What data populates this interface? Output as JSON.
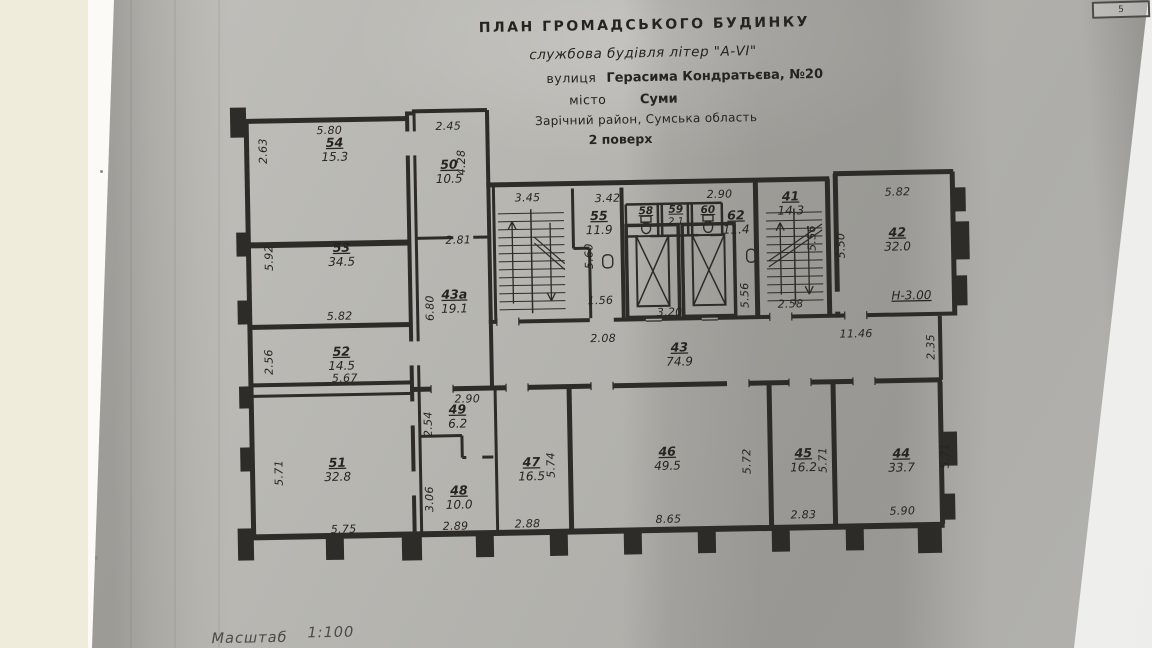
{
  "page": {
    "number": "5"
  },
  "title_block": {
    "line1": "ПЛАН  ГРОМАДСЬКОГО  БУДИНКУ",
    "line2": "службова будівля літер \"А-VI\"",
    "line3_label": "вулиця",
    "line3_value": "Герасима Кондратьєва, №20",
    "line4_label": "місто",
    "line4_value": "Суми",
    "line5": "Зарічний район, Сумська область",
    "line6": "2 поверх"
  },
  "scale": {
    "label": "Масштаб",
    "value": "1:100"
  },
  "height_mark": "Н-3.00",
  "rooms": {
    "r54": {
      "number": "54",
      "area": "15.3"
    },
    "r50": {
      "number": "50",
      "area": "10.5"
    },
    "r53": {
      "number": "53",
      "area": "34.5"
    },
    "r43a": {
      "number": "43а",
      "area": "19.1"
    },
    "r52": {
      "number": "52",
      "area": "14.5"
    },
    "r55": {
      "number": "55",
      "area": "11.9"
    },
    "r58": {
      "number": "58"
    },
    "r59": {
      "number": "59",
      "area": "2.1"
    },
    "r60": {
      "number": "60"
    },
    "r62": {
      "number": "62",
      "area": "11.4"
    },
    "r41": {
      "number": "41",
      "area": "14.3"
    },
    "r42": {
      "number": "42",
      "area": "32.0"
    },
    "r43": {
      "number": "43",
      "area": "74.9"
    },
    "r49": {
      "number": "49",
      "area": "6.2"
    },
    "r51": {
      "number": "51",
      "area": "32.8"
    },
    "r48": {
      "number": "48",
      "area": "10.0"
    },
    "r47": {
      "number": "47",
      "area": "16.5"
    },
    "r46": {
      "number": "46",
      "area": "49.5"
    },
    "r45": {
      "number": "45",
      "area": "16.2"
    },
    "r44": {
      "number": "44",
      "area": "33.7"
    }
  },
  "dims": {
    "d54_w": "5.80",
    "d54_h": "2.63",
    "d50_w": "2.45",
    "d50_h": "4.28",
    "d53_h": "5.92",
    "d53_w": "5.82",
    "d52_h": "2.56",
    "d52_w": "5.67",
    "d43a_w": "2.81",
    "d43a_h": "6.80",
    "stair_l_w": "3.45",
    "d55_w": "3.42",
    "d55_h": "5.60",
    "d55_b": "1.56",
    "d55_c": "2.08",
    "d62_w": "2.90",
    "lift_w": "3.20",
    "d62_h": "5.56",
    "stair_r_h": "5.56",
    "stair_r_b": "2.58",
    "d41_top": "14.3",
    "d42_w": "5.82",
    "d42_h": "5.50",
    "corr_r": "11.46",
    "corr_end": "2.35",
    "d49_w": "2.90",
    "d49_h": "2.54",
    "d48_h": "3.06",
    "d51_h": "5.71",
    "d51_w": "5.75",
    "d48_b": "2.89",
    "d47_b": "2.88",
    "d47_h": "5.74",
    "d46_b": "8.65",
    "d46_h": "5.72",
    "d45_b": "2.83",
    "d45_h": "5.71",
    "d44_b": "5.90",
    "d44_h": "5.71"
  }
}
